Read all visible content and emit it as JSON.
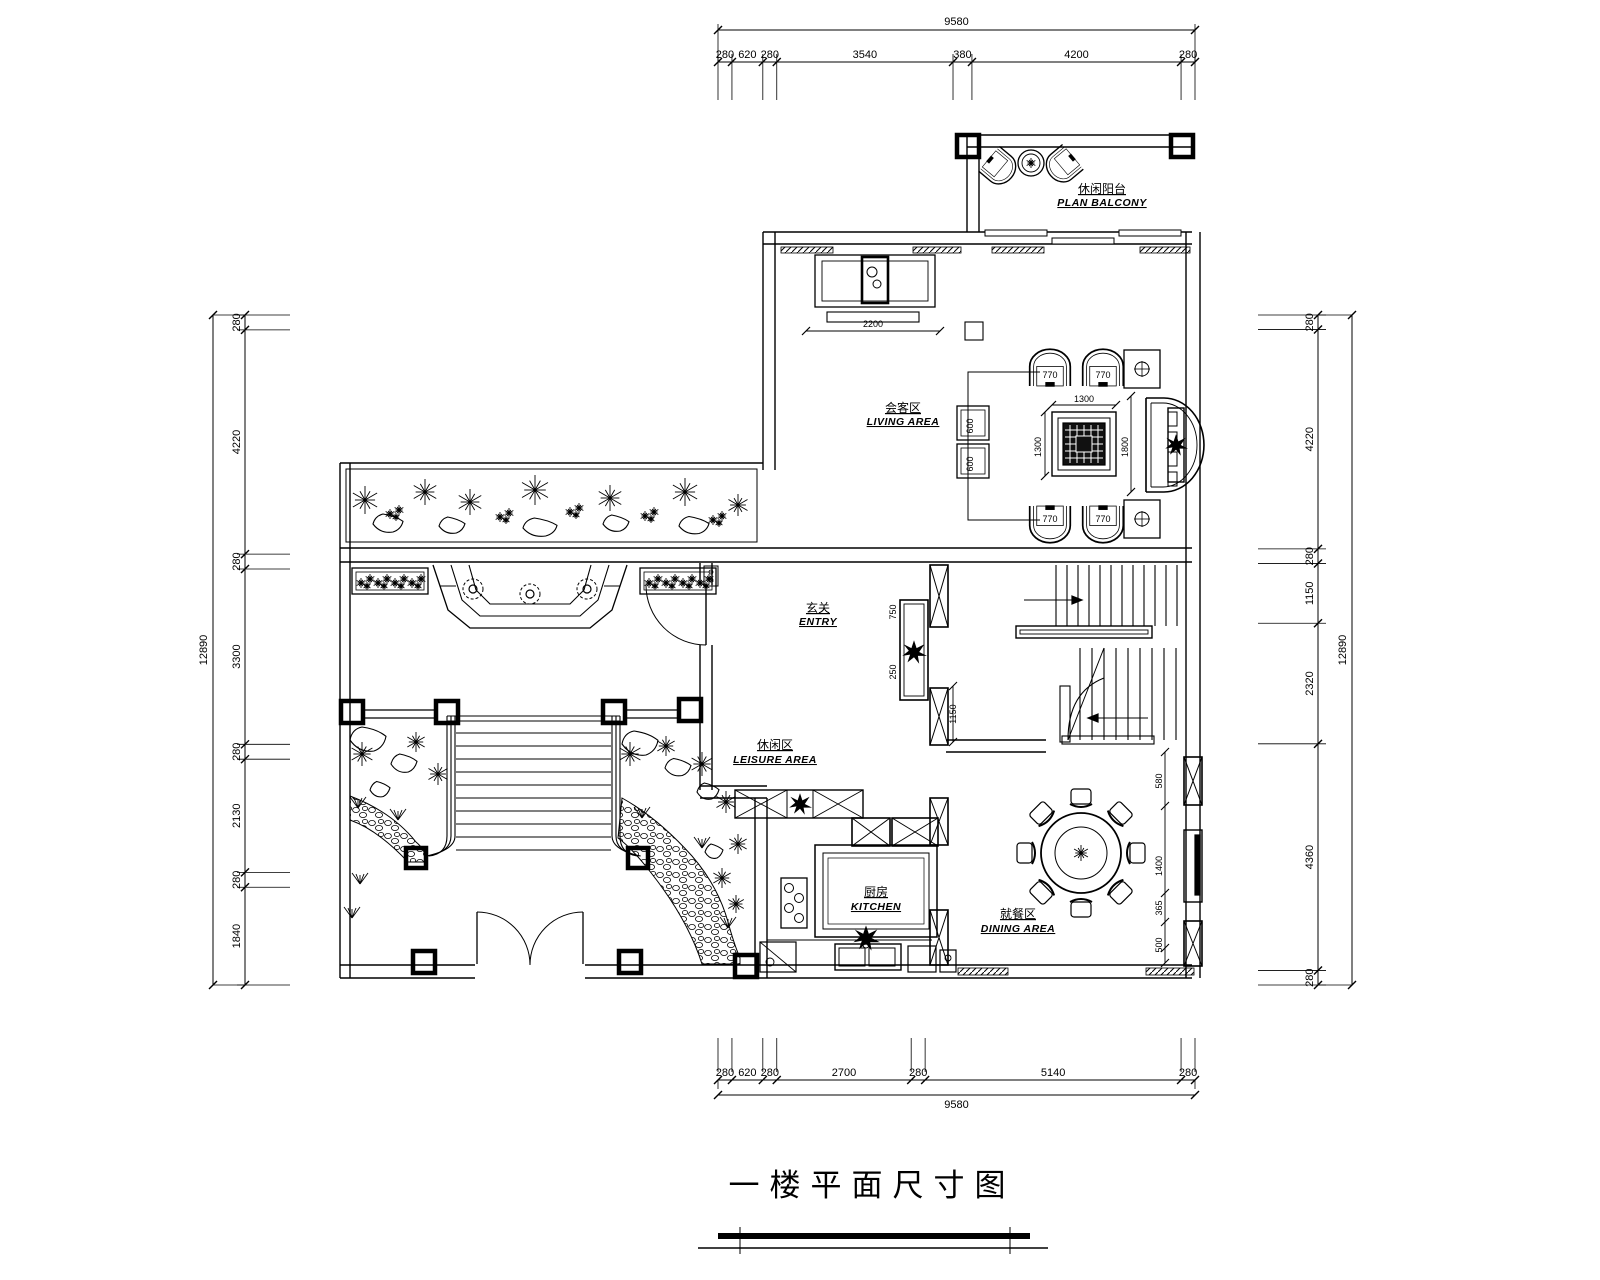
{
  "title": {
    "text": "一楼平面尺寸图"
  },
  "dimensions": {
    "top": {
      "total": "9580",
      "segments": [
        "280",
        "620",
        "280",
        "3540",
        "380",
        "4200",
        "280"
      ]
    },
    "bottom": {
      "total": "9580",
      "segments": [
        "280",
        "620",
        "280",
        "2700",
        "280",
        "5140",
        "280"
      ]
    },
    "left": {
      "total": "12890",
      "segments": [
        "280",
        "4220",
        "280",
        "3300",
        "280",
        "2130",
        "280",
        "1840"
      ]
    },
    "right": {
      "total": "12890",
      "segments": [
        "280",
        "4220",
        "280",
        "1150",
        "2320",
        "4360",
        "280"
      ]
    }
  },
  "rooms": {
    "balcony": {
      "zh": "休闲阳台",
      "en": "PLAN BALCONY"
    },
    "living": {
      "zh": "会客区",
      "en": "LIVING AREA"
    },
    "entry": {
      "zh": "玄关",
      "en": "ENTRY"
    },
    "leisure": {
      "zh": "休闲区",
      "en": "LEISURE AREA"
    },
    "kitchen": {
      "zh": "厨房",
      "en": "KITCHEN"
    },
    "dining": {
      "zh": "就餐区",
      "en": "DINING AREA"
    }
  },
  "interior": {
    "tv": "2200",
    "table_w": "1300",
    "table_h": "1300",
    "sofa": "1800",
    "chairs": [
      "770",
      "770",
      "770",
      "770"
    ],
    "side_tables": [
      "600",
      "600"
    ],
    "niche": [
      "750",
      "250"
    ],
    "stair": "1150",
    "right_chain": [
      "580",
      "1400",
      "365",
      "500"
    ]
  },
  "colors": {
    "line": "#000000",
    "background": "#ffffff"
  }
}
